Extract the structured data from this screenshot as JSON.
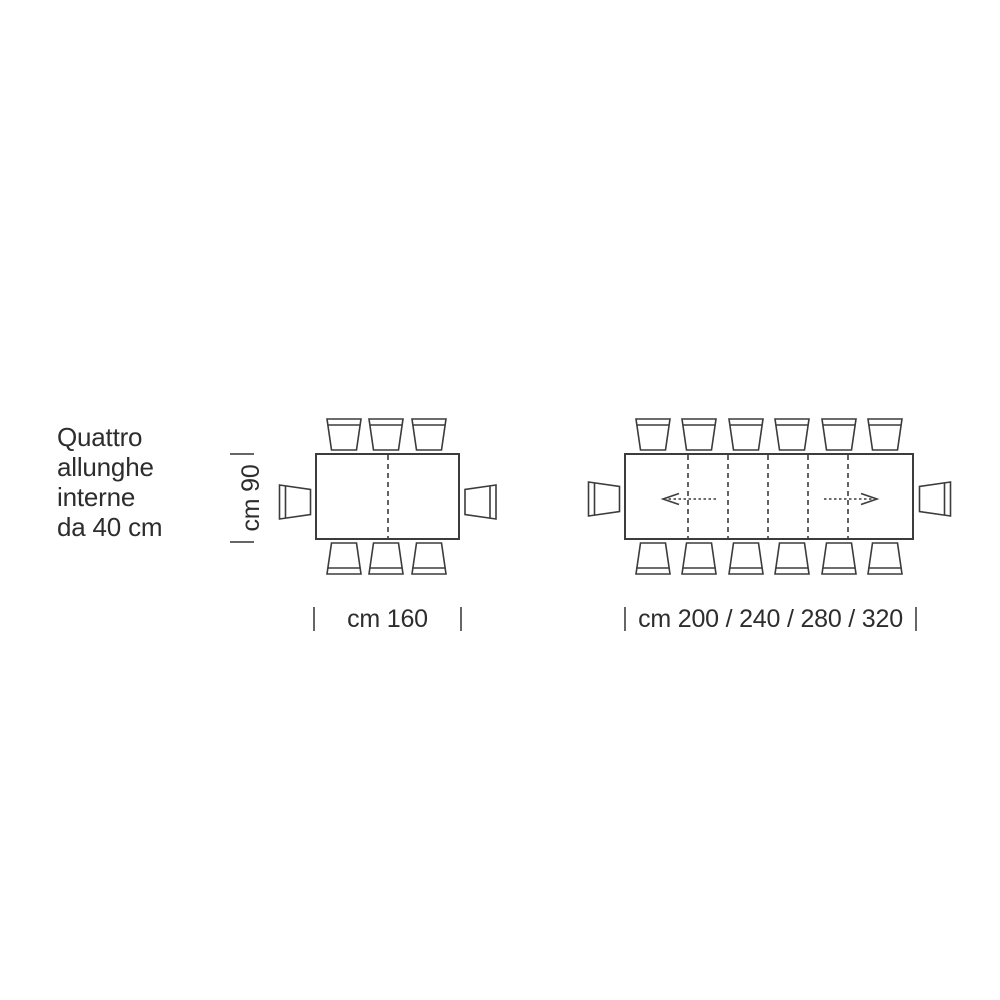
{
  "page": {
    "background": "#ffffff"
  },
  "annotation": {
    "lines": [
      "Quattro",
      "allunghe",
      "interne",
      "da 40 cm"
    ]
  },
  "closed_table": {
    "depth_label": "cm 90",
    "width_label": "cm 160",
    "chairs_top": 3,
    "chairs_bottom": 3,
    "chairs_left": 1,
    "chairs_right": 1
  },
  "extended_table": {
    "width_label": "cm 200 / 240 / 280 / 320",
    "extension_count": 4,
    "chairs_top": 6,
    "chairs_bottom": 6,
    "chairs_left": 1,
    "chairs_right": 1
  },
  "colors": {
    "line": "#3c3c3c",
    "text": "#2d2d2d",
    "tick": "#666666",
    "background": "#ffffff"
  }
}
